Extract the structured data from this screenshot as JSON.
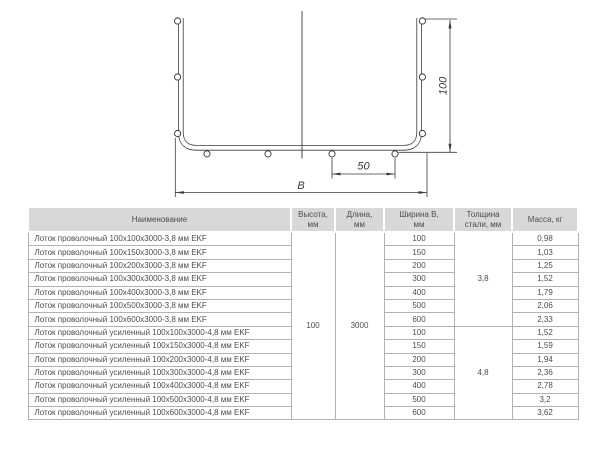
{
  "diagram": {
    "labels": {
      "width": "B",
      "hole_spacing": "50",
      "height": "100"
    }
  },
  "table": {
    "columns": [
      {
        "id": "name",
        "lines": [
          "Наименование"
        ]
      },
      {
        "id": "height",
        "lines": [
          "Высота,",
          "мм"
        ]
      },
      {
        "id": "length",
        "lines": [
          "Длина,",
          "мм"
        ]
      },
      {
        "id": "width",
        "lines": [
          "Ширина В,",
          "мм"
        ]
      },
      {
        "id": "thickness",
        "lines": [
          "Толщина",
          "стали, мм"
        ]
      },
      {
        "id": "mass",
        "lines": [
          "Масса, кг"
        ]
      }
    ],
    "shared": {
      "height": "100",
      "length": "3000"
    },
    "groups": [
      {
        "thickness": "3,8",
        "rows": [
          {
            "name": "Лоток проволочный 100х100х3000-3,8 мм EKF",
            "width": "100",
            "mass": "0,98"
          },
          {
            "name": "Лоток проволочный 100х150х3000-3,8 мм EKF",
            "width": "150",
            "mass": "1,03"
          },
          {
            "name": "Лоток проволочный 100х200х3000-3,8 мм EKF",
            "width": "200",
            "mass": "1,25"
          },
          {
            "name": "Лоток проволочный 100х300х3000-3,8 мм EKF",
            "width": "300",
            "mass": "1,52"
          },
          {
            "name": "Лоток проволочный 100х400х3000-3,8 мм EKF",
            "width": "400",
            "mass": "1,79"
          },
          {
            "name": "Лоток проволочный 100х500х3000-3,8 мм EKF",
            "width": "500",
            "mass": "2,06"
          },
          {
            "name": "Лоток проволочный 100х600х3000-3,8 мм EKF",
            "width": "600",
            "mass": "2,33"
          }
        ]
      },
      {
        "thickness": "4,8",
        "rows": [
          {
            "name": "Лоток проволочный усиленный 100х100х3000-4,8 мм EKF",
            "width": "100",
            "mass": "1,52"
          },
          {
            "name": "Лоток проволочный усиленный 100х150х3000-4,8 мм EKF",
            "width": "150",
            "mass": "1,59"
          },
          {
            "name": "Лоток проволочный усиленный 100х200х3000-4,8 мм EKF",
            "width": "200",
            "mass": "1,94"
          },
          {
            "name": "Лоток проволочный усиленный 100х300х3000-4,8 мм EKF",
            "width": "300",
            "mass": "2,36"
          },
          {
            "name": "Лоток проволочный усиленный 100х400х3000-4,8 мм EKF",
            "width": "400",
            "mass": "2,78"
          },
          {
            "name": "Лоток проволочный усиленный 100х500х3000-4,8 мм EKF",
            "width": "500",
            "mass": "3,2"
          },
          {
            "name": "Лоток проволочный усиленный 100х600х3000-4,8 мм EKF",
            "width": "600",
            "mass": "3,62"
          }
        ]
      }
    ]
  },
  "colors": {
    "header_bg": "#d8d8d8",
    "table_border": "#b2b2b2",
    "text": "#4d4d4d",
    "drawing_line": "#3a3a3a"
  }
}
